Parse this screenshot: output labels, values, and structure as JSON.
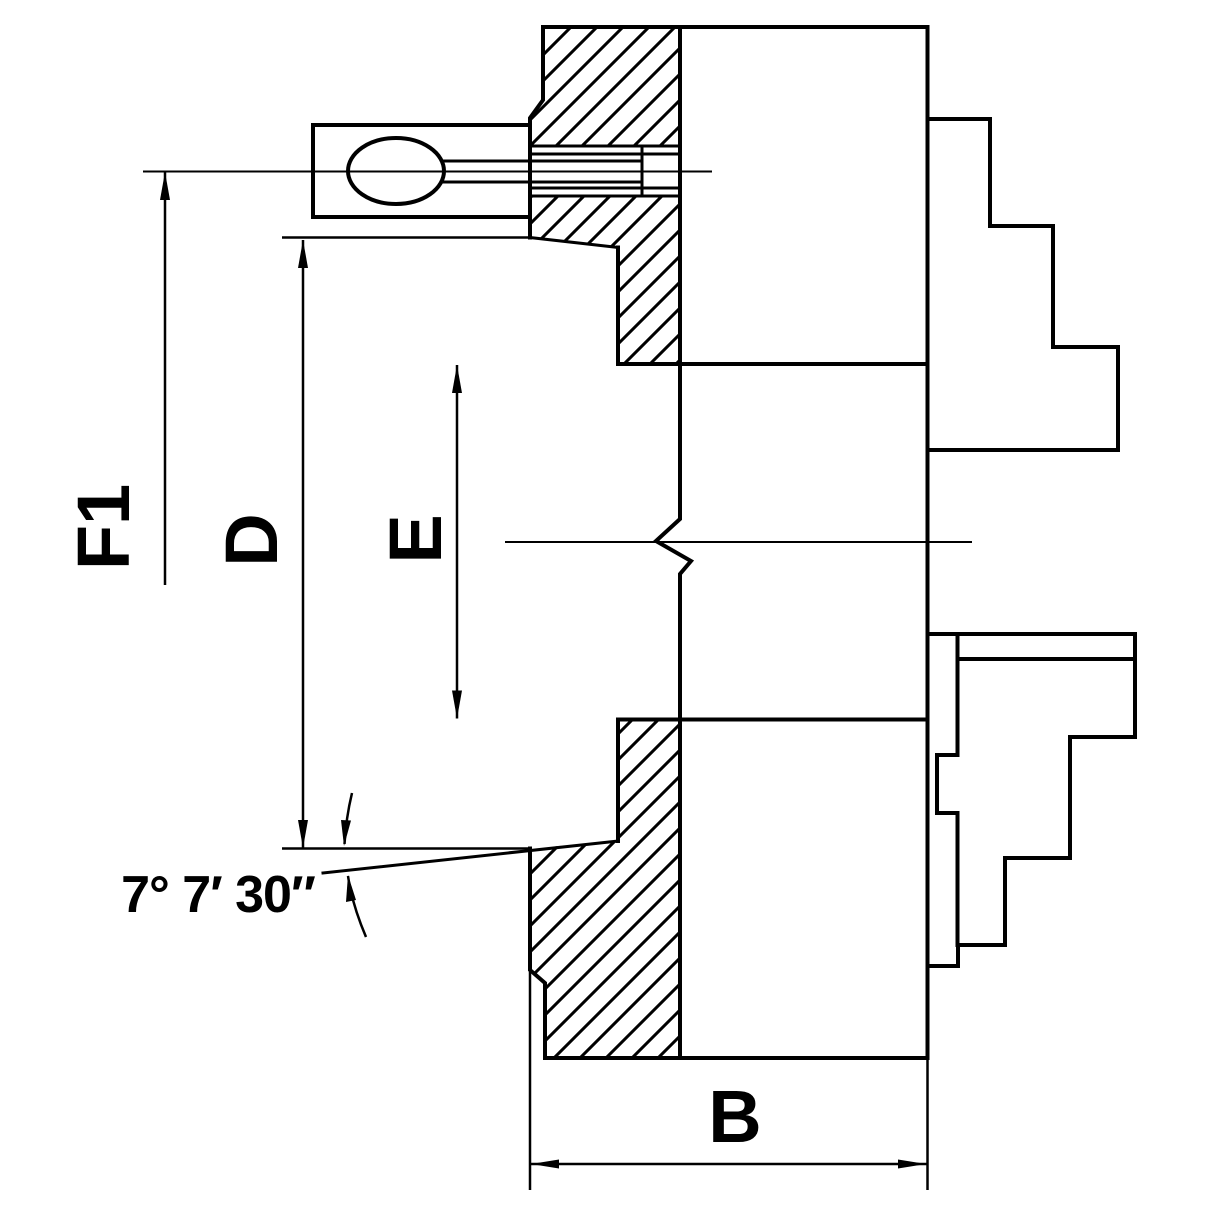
{
  "drawing": {
    "title": "Lathe chuck cross-section technical drawing",
    "background_color": "#ffffff",
    "line_color": "#000000",
    "dimensions": {
      "f1_label": "F1",
      "d_label": "D",
      "e_label": "E",
      "b_label": "B",
      "taper_angle_label": "7° 7′ 30″"
    }
  }
}
